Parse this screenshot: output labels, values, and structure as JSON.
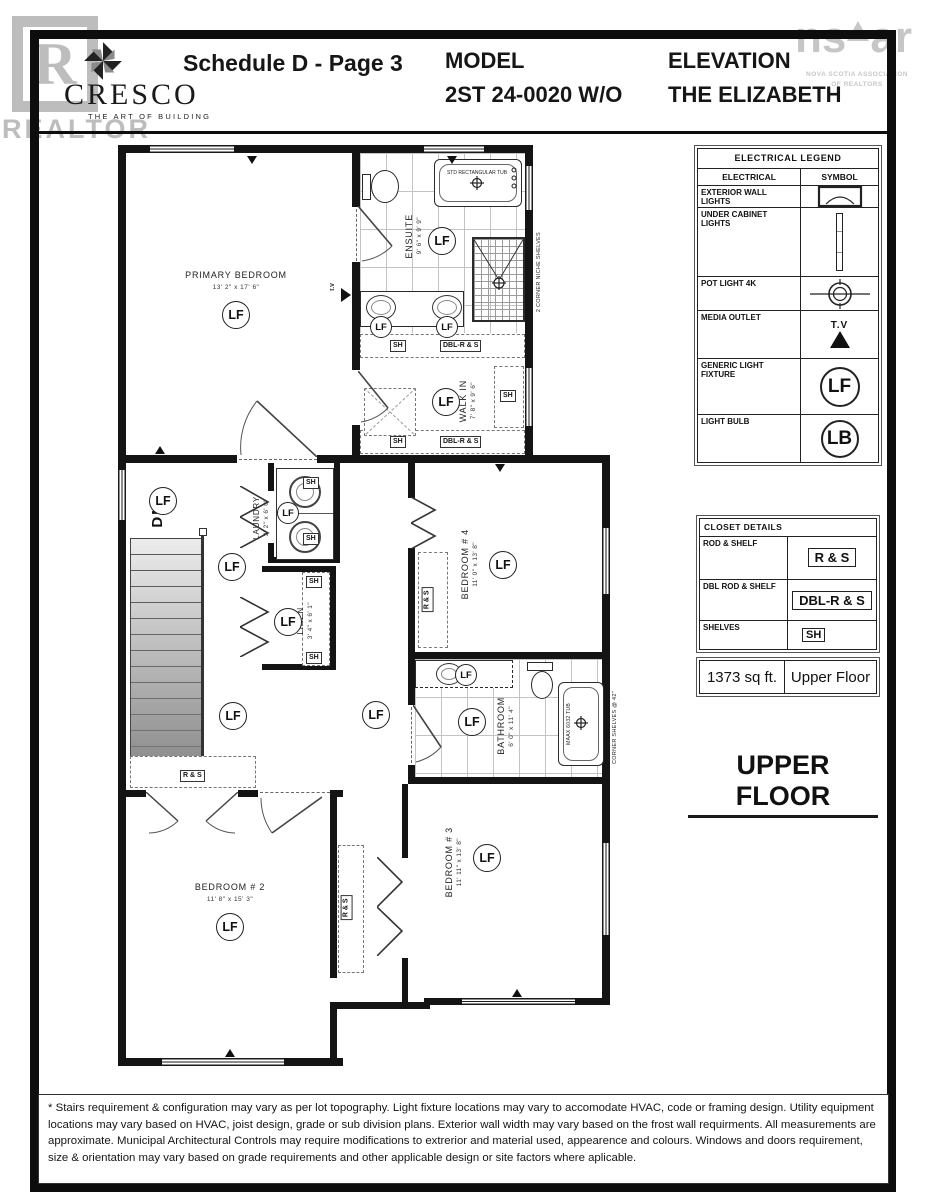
{
  "header": {
    "logo_name": "CRESCO",
    "logo_tagline": "THE ART OF BUILDING",
    "schedule_title": "Schedule D - Page 3",
    "model_label": "MODEL",
    "model_value": "2ST 24-0020 W/O",
    "elevation_label": "ELEVATION",
    "elevation_value": "THE ELIZABETH"
  },
  "watermarks": {
    "realtor_letter": "R",
    "realtor_text": "REALTOR",
    "nsar_left": "ns",
    "nsar_right": "ar",
    "nsar_sub1": "NOVA SCOTIA ASSOCIATION",
    "nsar_sub2": "OF REALTORS"
  },
  "electrical_legend": {
    "title": "ELECTRICAL LEGEND",
    "col1": "ELECTRICAL",
    "col2": "SYMBOL",
    "rows": [
      {
        "label": "EXTERIOR WALL LIGHTS",
        "symbol": "wall-light-icon"
      },
      {
        "label": "UNDER CABINET LIGHTS",
        "symbol": "under-cabinet-light-icon"
      },
      {
        "label": "POT LIGHT 4K",
        "symbol": "pot-light-icon"
      },
      {
        "label": "MEDIA OUTLET",
        "symbol": "tv-icon",
        "symbol_text": "T.V"
      },
      {
        "label": "GENERIC LIGHT FIXTURE",
        "symbol": "circle-label",
        "symbol_text": "LF"
      },
      {
        "label": "LIGHT BULB",
        "symbol": "circle-label",
        "symbol_text": "LB"
      }
    ]
  },
  "closet_details": {
    "title": "CLOSET DETAILS",
    "rows": [
      {
        "label": "ROD & SHELF",
        "code": "R & S"
      },
      {
        "label": "DBL ROD & SHELF",
        "code": "DBL-R & S"
      },
      {
        "label": "SHELVES",
        "code": "SH"
      }
    ]
  },
  "area_box": {
    "sqft": "1373 sq ft.",
    "floor": "Upper Floor"
  },
  "floor_title": "UPPER FLOOR",
  "plan": {
    "rooms": {
      "primary": {
        "name": "PRIMARY BEDROOM",
        "dims": "13' 2\" x 17' 6\""
      },
      "ensuite": {
        "name": "ENSUITE",
        "dims": "9' 6\" x 9' 9\""
      },
      "walkin": {
        "name": "WALK IN",
        "dims": "7' 8\" x 9' 6\""
      },
      "laundry": {
        "name": "LAUNDRY",
        "dims": "3' 2\" x 6' 0\""
      },
      "linen": {
        "name": "LINEN",
        "dims": "3' 4\" x 6' 1\""
      },
      "bed4": {
        "name": "BEDROOM # 4",
        "dims": "11' 0\" x 13' 8\""
      },
      "bath": {
        "name": "BATHROOM",
        "dims": "6' 0\" x 11' 4\""
      },
      "bed3": {
        "name": "BEDROOM # 3",
        "dims": "11' 11\" x 13' 8\""
      },
      "bed2": {
        "name": "BEDROOM # 2",
        "dims": "11' 8\" x 15' 3\""
      }
    },
    "labels": {
      "lf": "LF",
      "dn": "DN",
      "tv": "T.V",
      "sh": "SH",
      "rs": "R & S",
      "dblrs": "DBL-R & S",
      "tub_std": "STD RECTANGULAR TUB",
      "tub_maax": "MAAX 6032 TUB",
      "niche_note": "2 CORNER NICHE SHELVES",
      "corner_note": "CORNER SHELVES @ 42\""
    }
  },
  "footer": {
    "disclaimer": "* Stairs requirement & configuration may vary as per lot topography. Light fixture locations may vary to accomodate HVAC, code or framing design. Utility equipment locations may vary based on HVAC, joist design, grade or sub division plans. Exterior wall width may vary based on the frost wall requirments. All measurements are approximate. Municipal Architectural Controls may require modifications to extrerior and material used, appearence and colours. Windows and doors requirement, size & orientation may vary based on grade requirements and other applicable design or site factors where aplicable."
  },
  "colors": {
    "wall": "#141414",
    "watermark": "#bdbdbd"
  }
}
